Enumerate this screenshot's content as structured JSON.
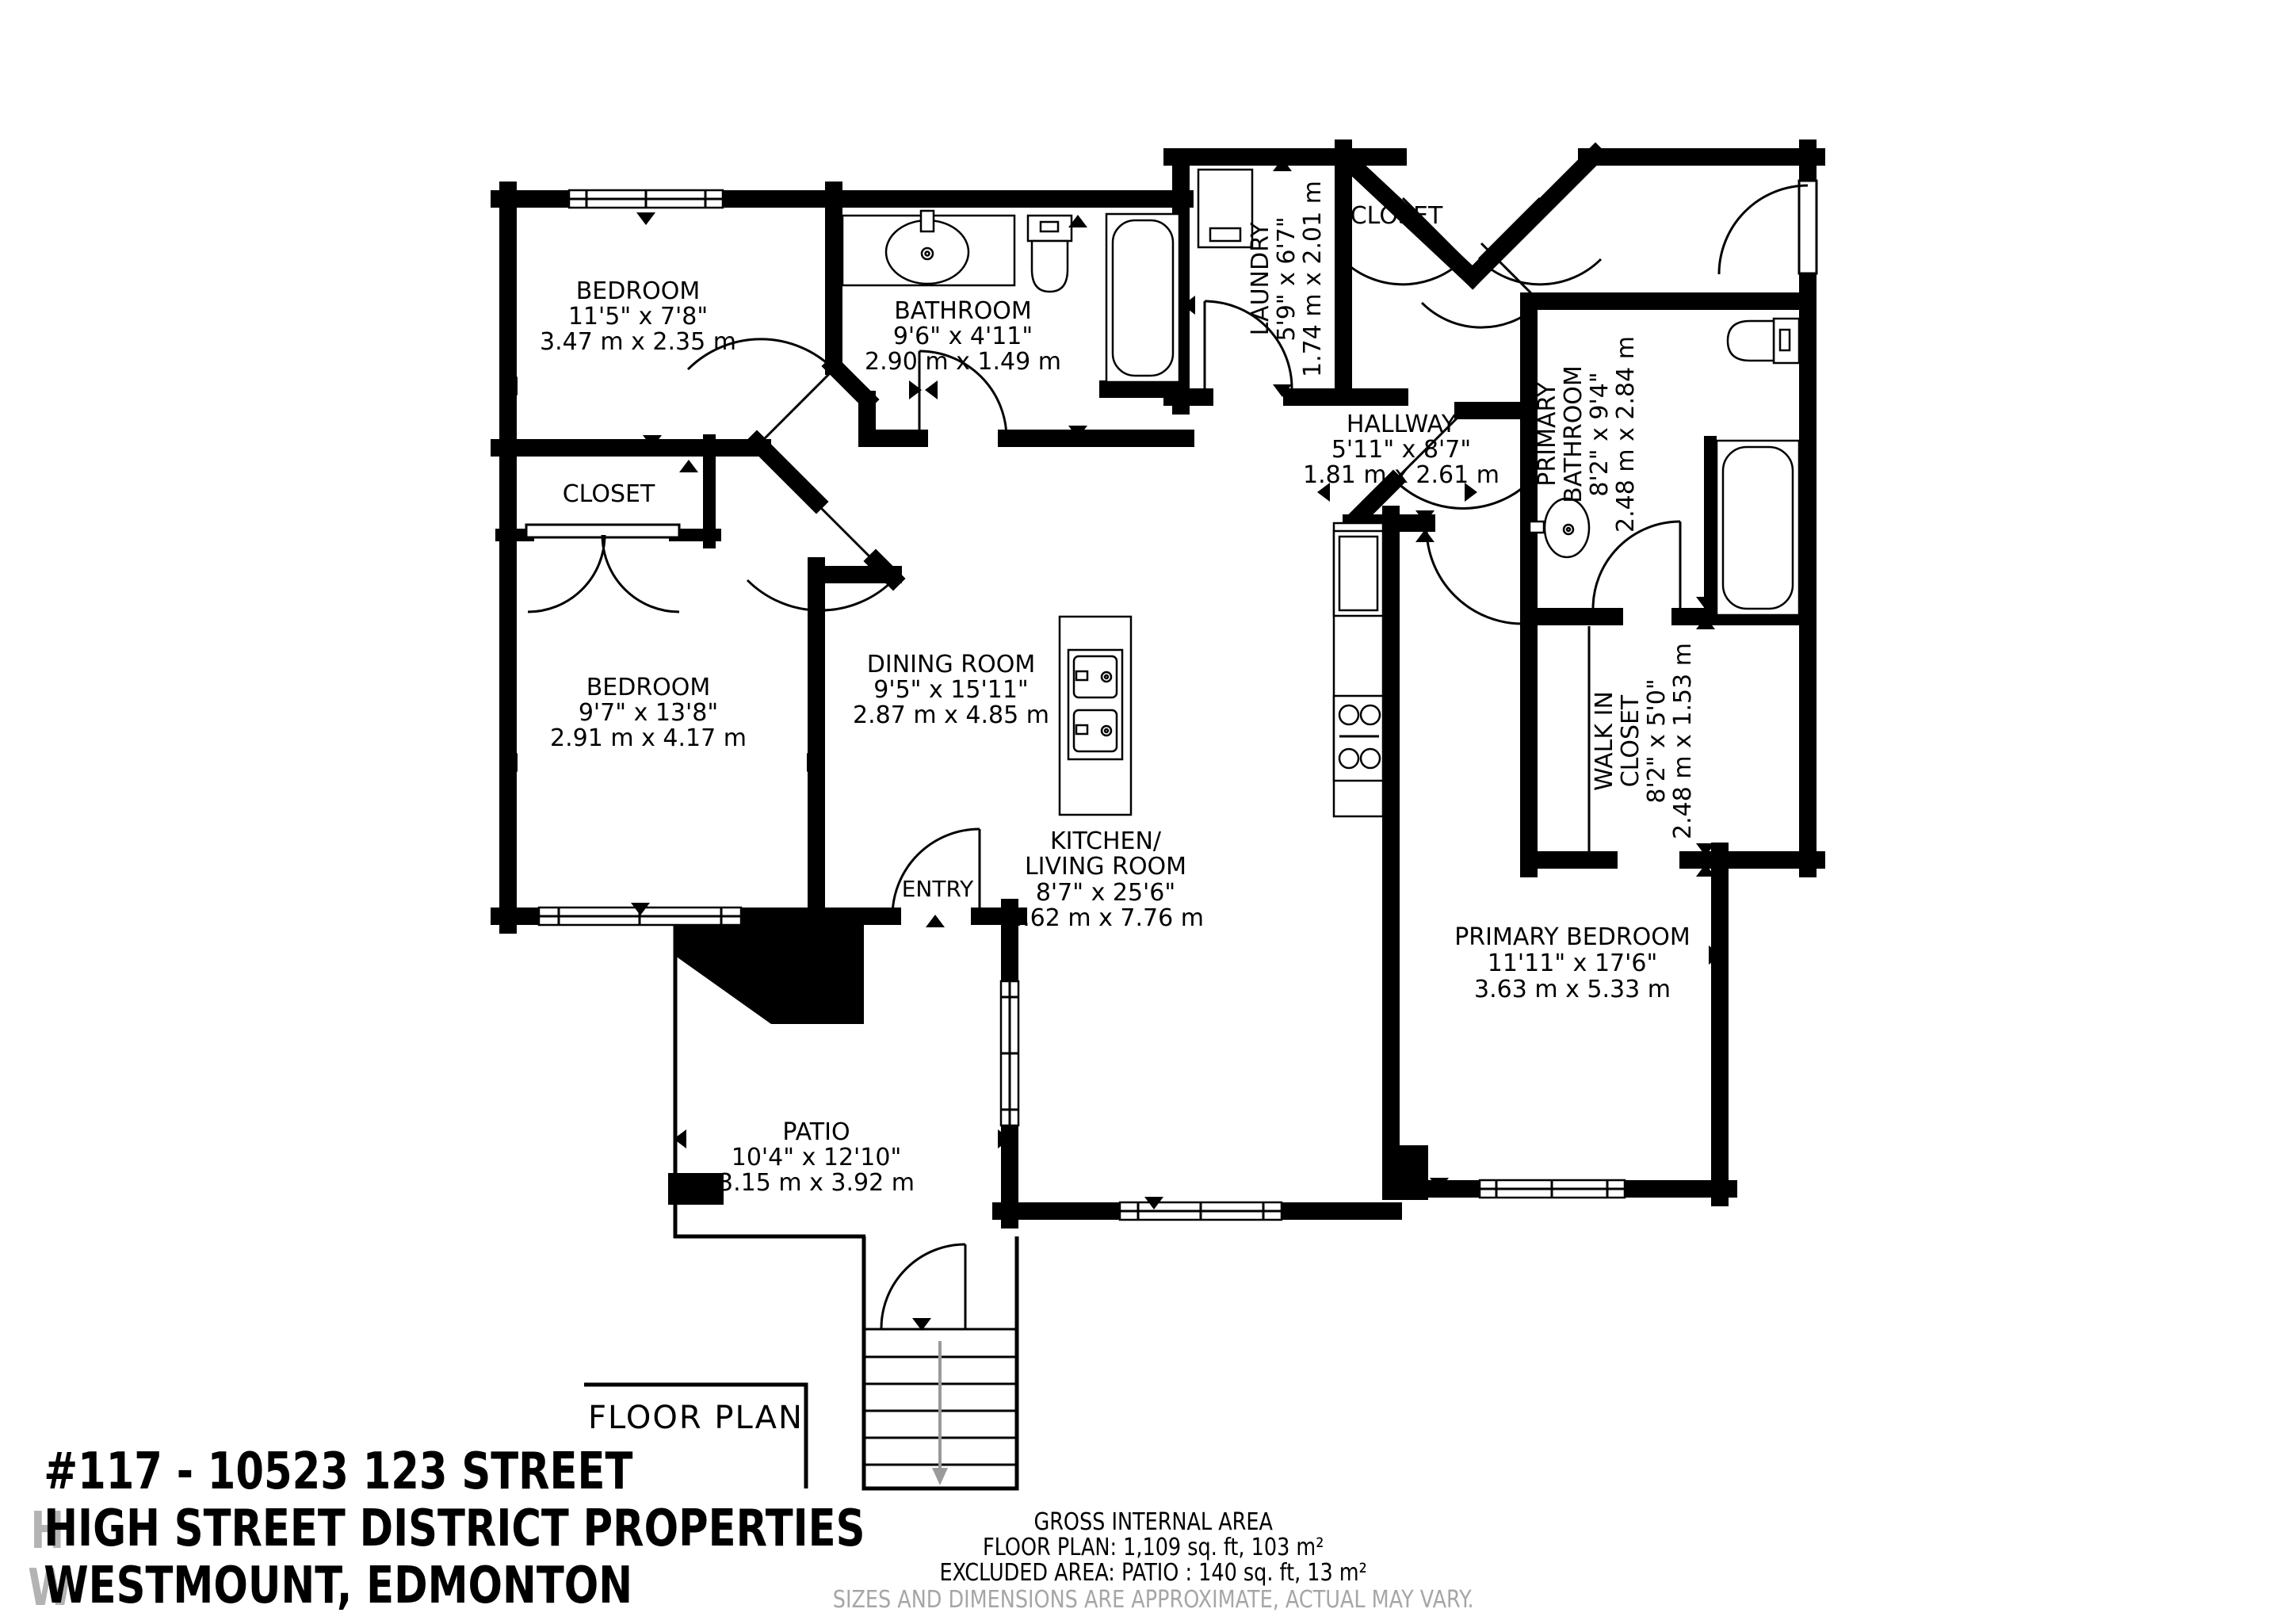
{
  "colors": {
    "wall": "#000000",
    "background": "#ffffff",
    "muted_text": "#a6a6a6"
  },
  "rooms": [
    {
      "name": "BEDROOM",
      "dims_ft": "11'5\" x 7'8\"",
      "dims_m": "3.47 m x 2.35 m"
    },
    {
      "name": "BATHROOM",
      "dims_ft": "9'6\" x 4'11\"",
      "dims_m": "2.90 m x 1.49 m"
    },
    {
      "name": "LAUNDRY",
      "dims_ft": "5'9\" x 6'7\"",
      "dims_m": "1.74 m x 2.01 m"
    },
    {
      "name": "CLOSET"
    },
    {
      "name": "HALLWAY",
      "dims_ft": "5'11\" x 8'7\"",
      "dims_m": "1.81 m x 2.61 m"
    },
    {
      "name_line1": "PRIMARY",
      "name_line2": "BATHROOM",
      "dims_ft": "8'2\" x 9'4\"",
      "dims_m": "2.48 m x 2.84 m"
    },
    {
      "name": "CLOSET"
    },
    {
      "name": "BEDROOM",
      "dims_ft": "9'7\" x 13'8\"",
      "dims_m": "2.91 m x 4.17 m"
    },
    {
      "name": "DINING ROOM",
      "dims_ft": "9'5\" x 15'11\"",
      "dims_m": "2.87 m x 4.85 m"
    },
    {
      "name_line1": "WALK IN",
      "name_line2": "CLOSET",
      "dims_ft": "8'2\" x 5'0\"",
      "dims_m": "2.48 m x 1.53 m"
    },
    {
      "name_line1": "KITCHEN/",
      "name_line2": "LIVING ROOM",
      "dims_ft": "8'7\" x 25'6\"",
      "dims_m": "2.62 m x 7.76 m"
    },
    {
      "name": "ENTRY"
    },
    {
      "name": "PRIMARY BEDROOM",
      "dims_ft": "11'11\" x 17'6\"",
      "dims_m": "3.63 m x 5.33 m"
    },
    {
      "name": "PATIO",
      "dims_ft": "10'4\" x 12'10\"",
      "dims_m": "3.15 m x 3.92 m"
    }
  ],
  "plan_label": "FLOOR PLAN",
  "title_block": {
    "line1": "#117 - 10523 123 STREET",
    "line2": "HIGH STREET DISTRICT PROPERTIES",
    "line3": "WESTMOUNT, EDMONTON"
  },
  "area_summary": {
    "heading": "GROSS INTERNAL AREA",
    "floor_plan_area": "FLOOR PLAN: 1,109 sq. ft, 103 m²",
    "excluded_area": "EXCLUDED AREA: PATIO      : 140 sq. ft, 13 m²",
    "disclaimer": "SIZES AND DIMENSIONS ARE APPROXIMATE, ACTUAL MAY VARY."
  }
}
